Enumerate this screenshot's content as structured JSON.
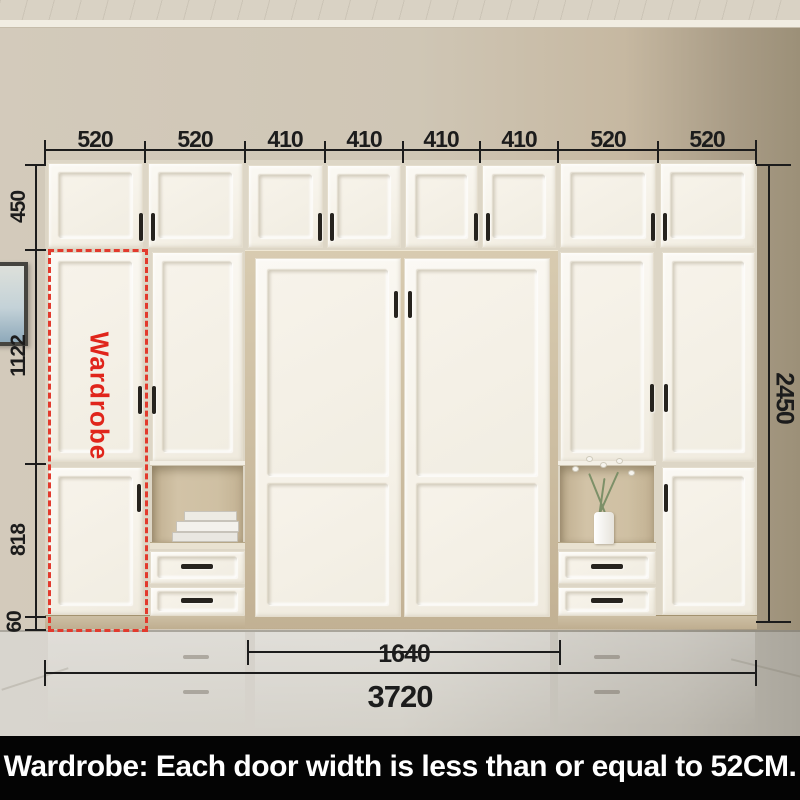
{
  "banner": {
    "text": "Wardrobe: Each door width is less than or equal to 52CM."
  },
  "annotation": {
    "wardrobe_label": "Wardrobe"
  },
  "dimensions": {
    "top_section_widths_mm": [
      "520",
      "520",
      "410",
      "410",
      "410",
      "410",
      "520",
      "520"
    ],
    "left_section_heights_mm": [
      "450",
      "1122",
      "818",
      "60"
    ],
    "total_height_mm": "2450",
    "bed_cabinet_width_mm": "1640",
    "total_width_mm": "3720"
  },
  "colors": {
    "annotation_red": "#e23a2d",
    "dimension_line": "#1c1c1c",
    "cabinet_white": "#f7f4ee",
    "wood_accent": "#cbbda3",
    "banner_bg": "#040404",
    "banner_text": "#ffffff"
  }
}
